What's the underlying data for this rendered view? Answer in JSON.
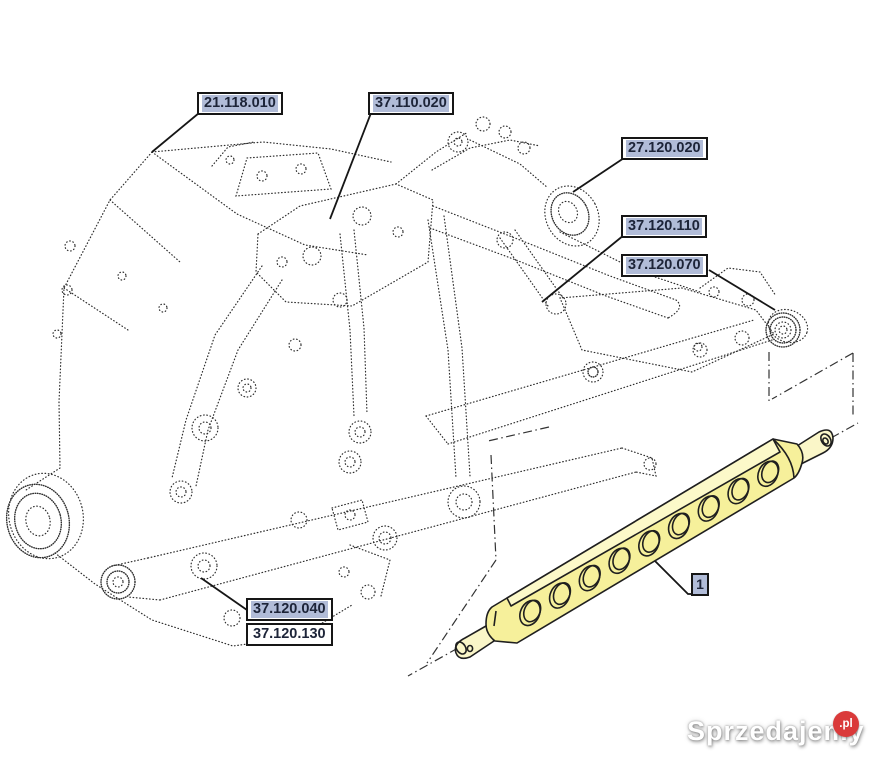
{
  "diagram": {
    "part_labels": [
      {
        "text": "21.118.010",
        "highlighted": true
      },
      {
        "text": "37.110.020",
        "highlighted": true
      },
      {
        "text": "27.120.020",
        "highlighted": true
      },
      {
        "text": "37.120.110",
        "highlighted": true
      },
      {
        "text": "37.120.070",
        "highlighted": true
      },
      {
        "text": "37.120.040",
        "highlighted": true
      },
      {
        "text": "37.120.130",
        "highlighted": false
      }
    ],
    "callout_number": "1",
    "highlighted_part": {
      "callout": "1",
      "description": "drawbar-with-holes",
      "hole_count": 9,
      "fill_color": "#f6f09b"
    },
    "colors": {
      "label_highlight": "#b1bcd8",
      "part_fill": "#f6f09b",
      "part_bevel": "#fcf9c9",
      "line": "#2e2e2e"
    }
  },
  "watermark": {
    "name": "Sprzedajemy",
    "suffix": ".pl",
    "badge_color": "#da3a3a"
  }
}
